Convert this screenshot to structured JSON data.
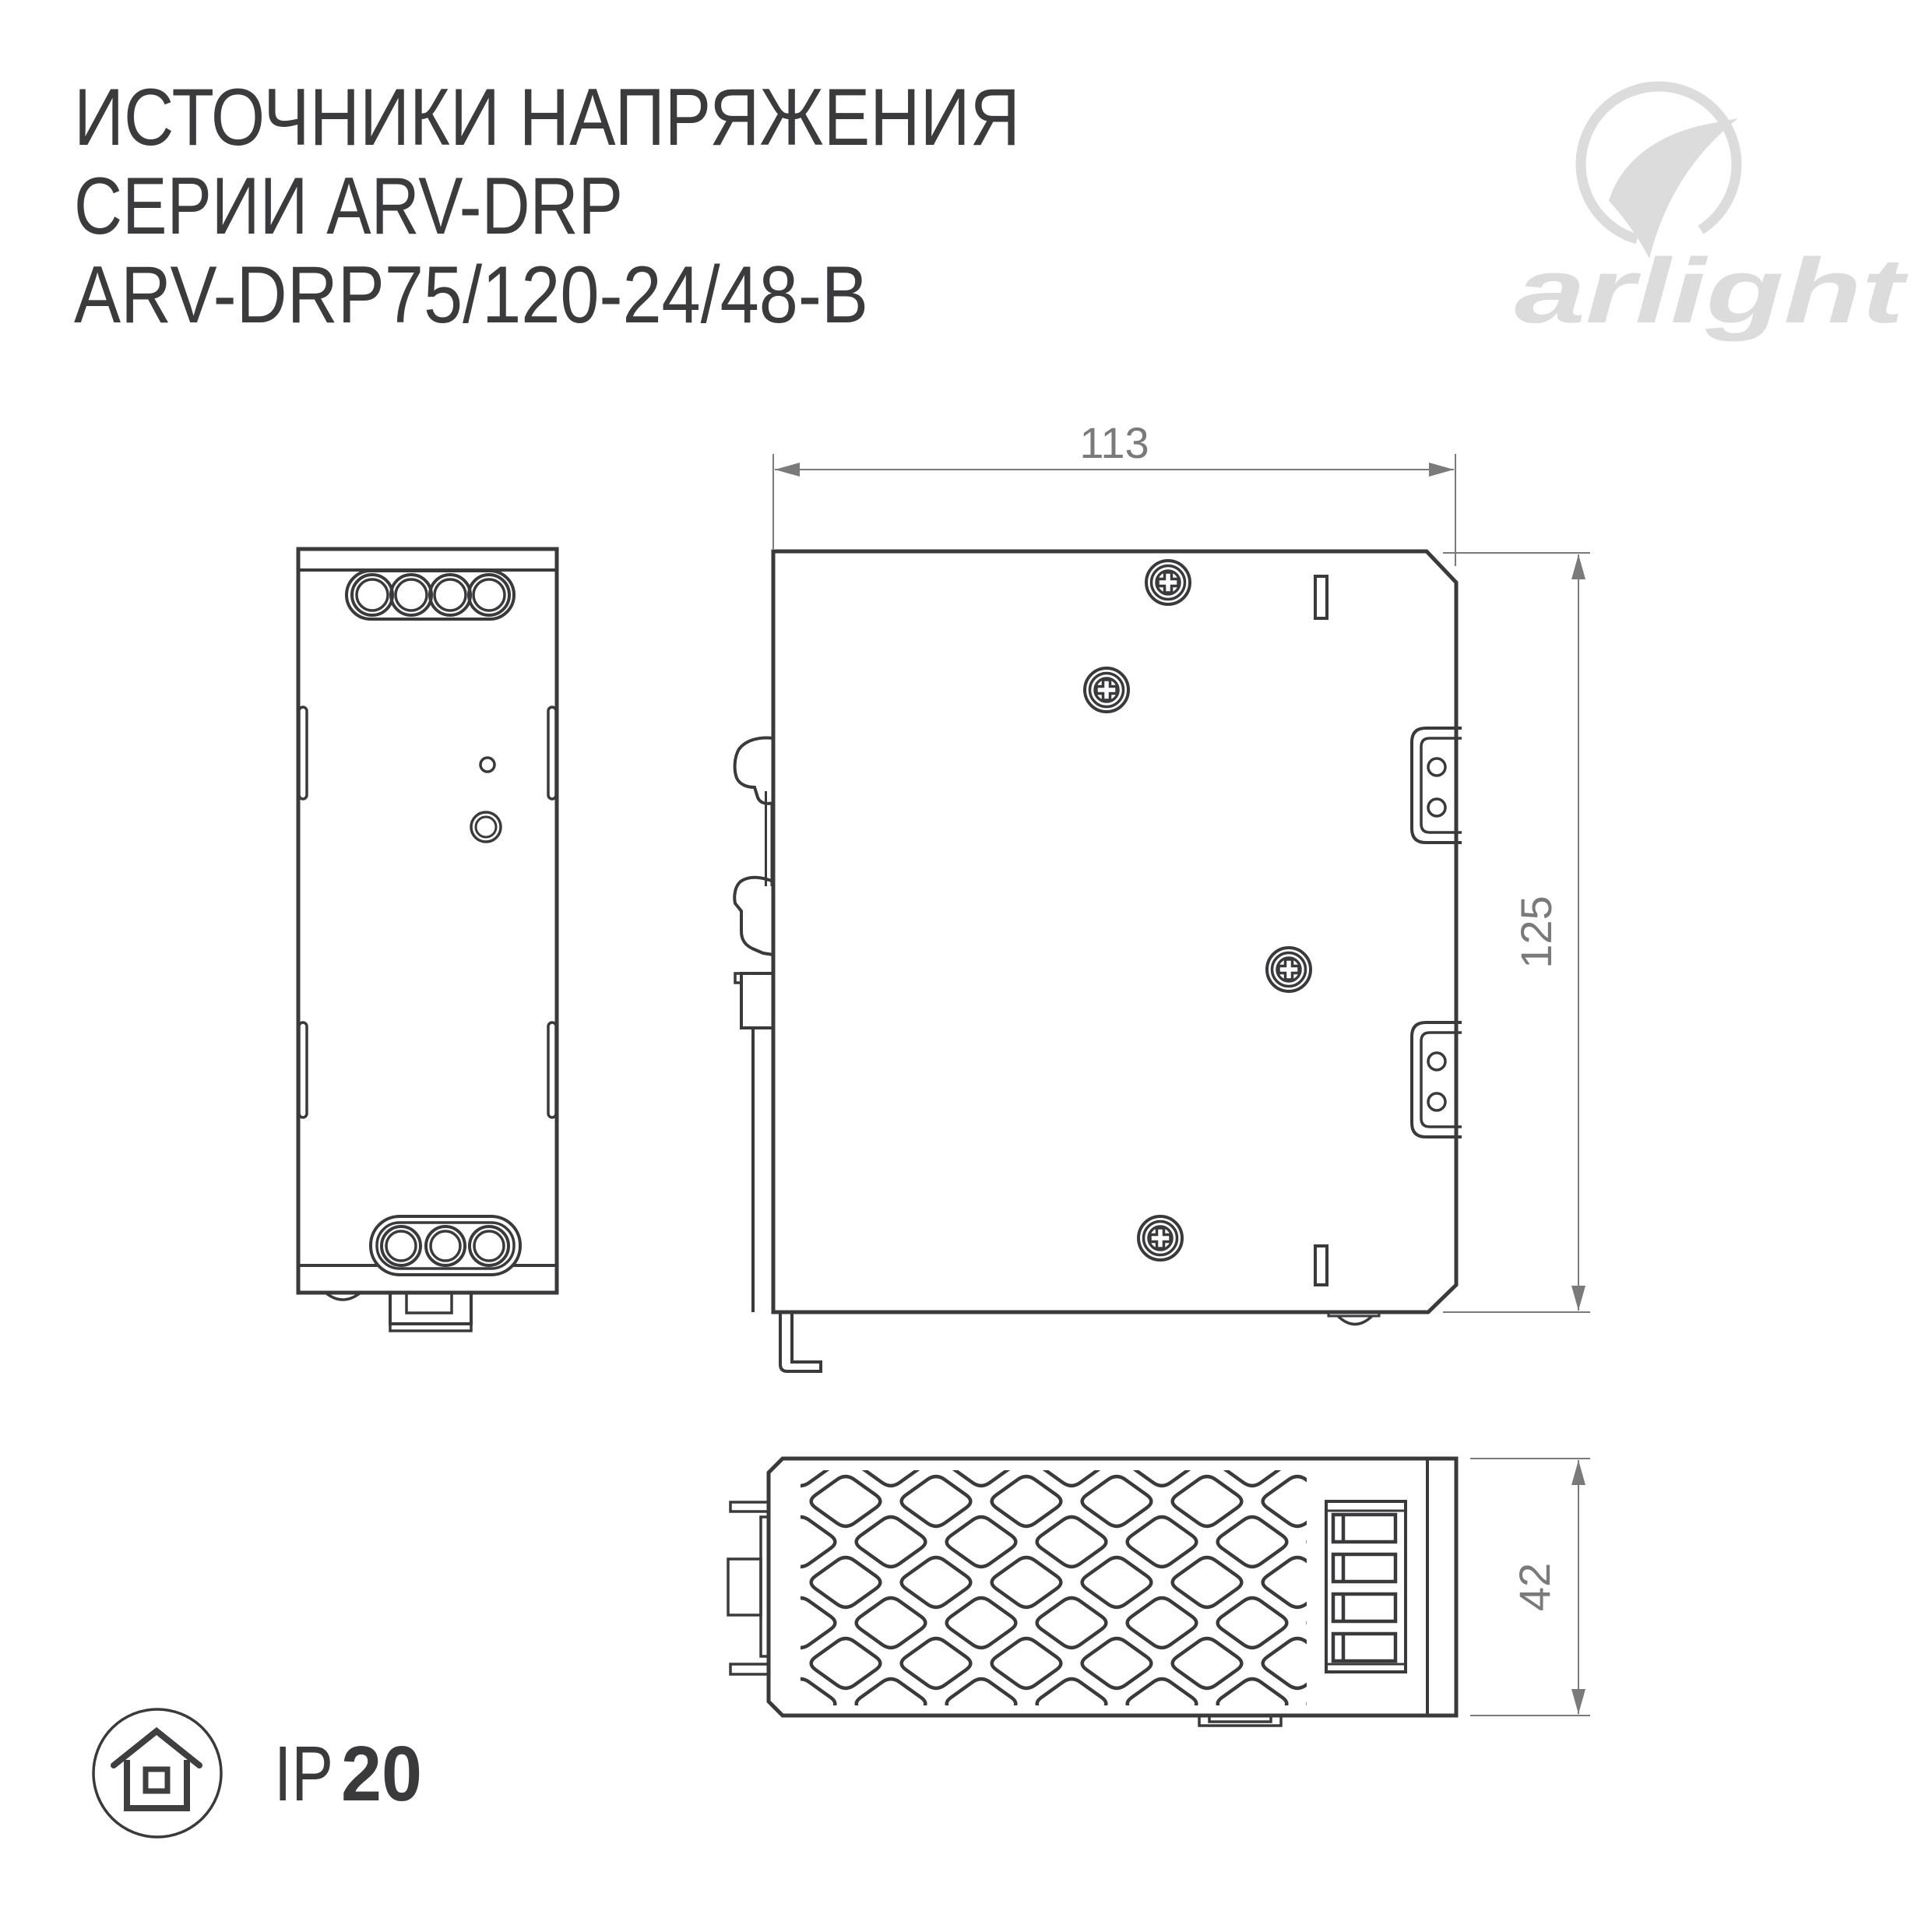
{
  "title": {
    "line1": "ИСТОЧНИКИ НАПРЯЖЕНИЯ",
    "line2": "СЕРИИ ARV-DRP",
    "line3": "ARV-DRP75/120-24/48-B"
  },
  "logo": {
    "brand": "arlight",
    "mark": "swoosh-circle-icon"
  },
  "dimensions": {
    "width_mm": "113",
    "height_mm": "125",
    "depth_mm": "42"
  },
  "ip_badge": {
    "prefix": "IP",
    "value": "20",
    "icon": "house-icon"
  },
  "icons": {
    "screw": "phillips-screw-icon",
    "vent": "diamond-vent-grid"
  },
  "colors": {
    "drawing_line": "#3a3a3c",
    "dimension_line": "#7a7a7a",
    "title_text": "#3b3b3d",
    "logo_gray": "#dcdcdc",
    "background": "#ffffff"
  }
}
